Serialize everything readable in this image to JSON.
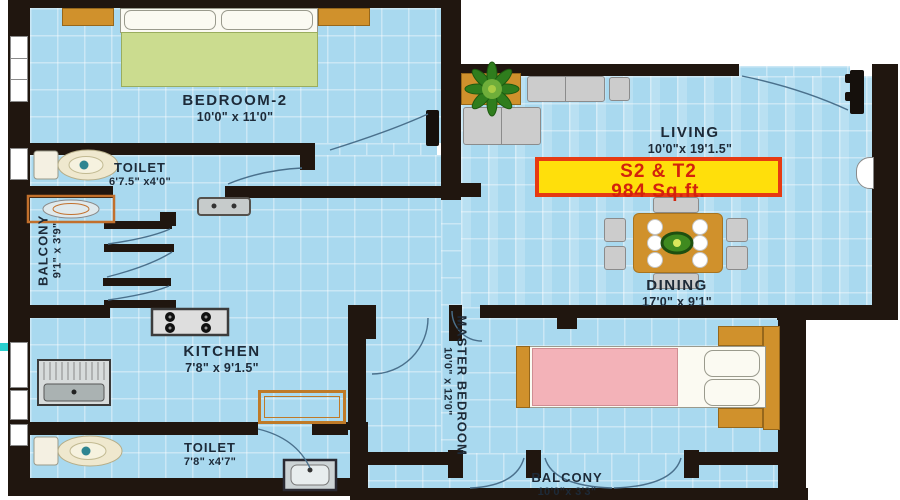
{
  "title": "Apartment unit floor plan",
  "unit_badge": {
    "line1": "S2 & T2",
    "line2": "984 Sq.ft."
  },
  "rooms": {
    "bedroom2": {
      "name": "BEDROOM-2",
      "dims": "10'0\" x 11'0\""
    },
    "toilet1": {
      "name": "TOILET",
      "dims": "6'7.5\" x4'0\""
    },
    "balcony_left": {
      "name": "BALCONY",
      "dims": "9'1\" x 3'9\""
    },
    "living": {
      "name": "LIVING",
      "dims": "10'0\"x 19'1.5\""
    },
    "dining": {
      "name": "DINING",
      "dims": "17'0\" x 9'1\""
    },
    "kitchen": {
      "name": "KITCHEN",
      "dims": "7'8\" x 9'1.5\""
    },
    "master_bedroom": {
      "name": "MASTER BEDROOM",
      "dims": "10'0\" x 12'0\""
    },
    "toilet2": {
      "name": "TOILET",
      "dims": "7'8\" x4'7\""
    },
    "balcony_bottom": {
      "name": "BALCONY",
      "dims": "10'0\"x 3'3\""
    }
  },
  "colors": {
    "floor": "#a9d9ef",
    "wall": "#20160f",
    "wood": "#d0912c",
    "bed2_mattress": "#cbdc8f",
    "master_mattress": "#f3b2b8",
    "badge_bg": "#ffdf0b",
    "badge_border": "#e63a12",
    "badge_text": "#d3220c",
    "label_text": "#1d2a38"
  }
}
